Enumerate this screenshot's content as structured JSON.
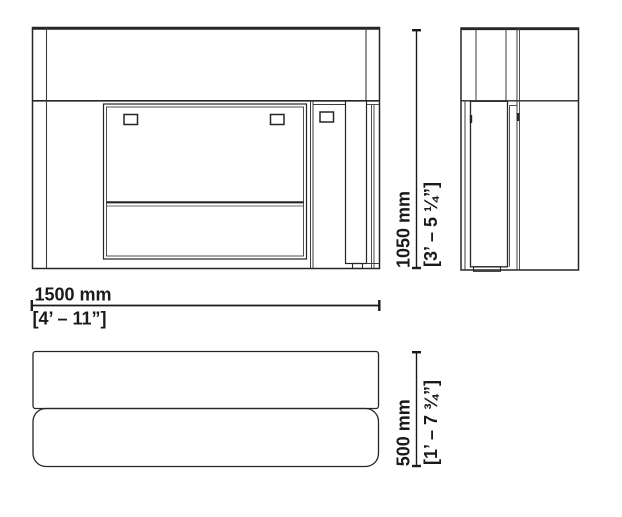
{
  "drawing": {
    "background": "#ffffff",
    "line_color": "#262626",
    "views": {
      "front": "front-elevation",
      "side": "side-elevation",
      "top": "plan-view"
    },
    "dimensions": {
      "width": {
        "metric": "1500 mm",
        "imperial": "[4’ – 11”]"
      },
      "height": {
        "metric": "1050 mm",
        "imperial": "[3’ – 5 ¼”]"
      },
      "depth": {
        "metric": "500 mm",
        "imperial": "[1’ – 7 ¾”]"
      }
    }
  }
}
